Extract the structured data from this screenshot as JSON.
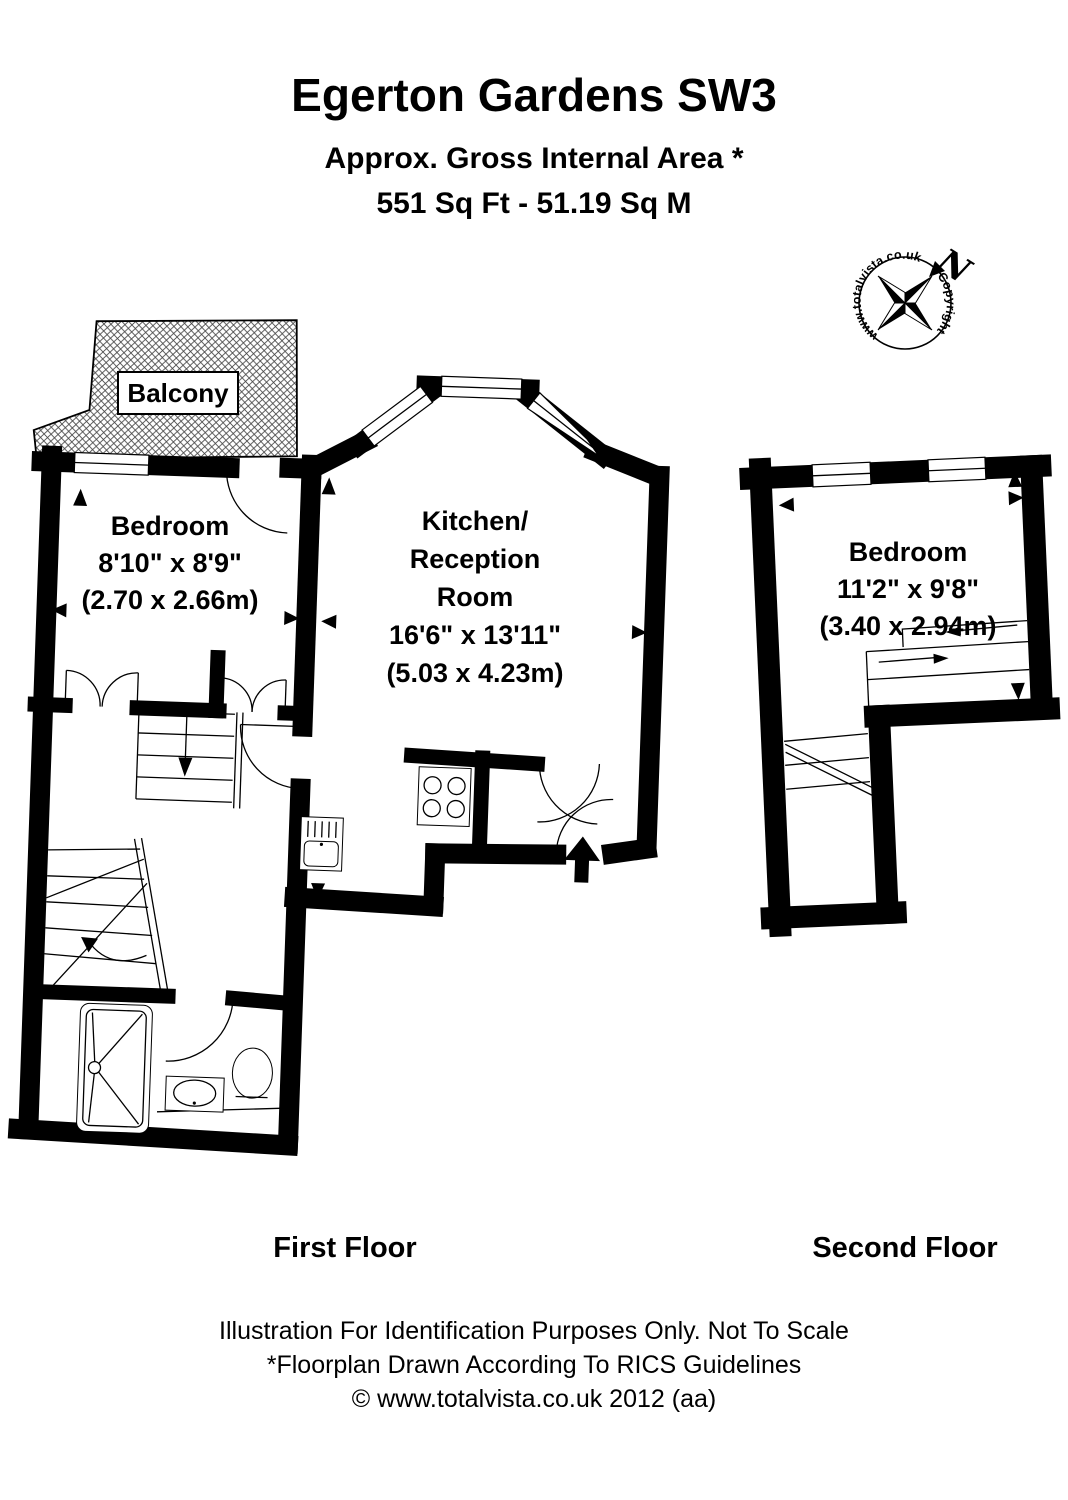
{
  "header": {
    "title": "Egerton Gardens SW3",
    "subtitle_line1": "Approx. Gross Internal Area *",
    "subtitle_line2": "551 Sq Ft  -  51.19 Sq M"
  },
  "compass": {
    "ring_text_left": "www.totalvista.co.uk",
    "ring_text_right": "Copyright",
    "north_label": "N"
  },
  "floorplan": {
    "balcony_label": "Balcony",
    "rooms": {
      "bedroom_first_floor": {
        "name": "Bedroom",
        "imperial": "8'10\" x 8'9\"",
        "metric": "(2.70 x 2.66m)"
      },
      "kitchen_reception": {
        "name_line1": "Kitchen/",
        "name_line2": "Reception",
        "name_line3": "Room",
        "imperial": "16'6\" x 13'11\"",
        "metric": "(5.03 x 4.23m)"
      },
      "bedroom_second_floor": {
        "name": "Bedroom",
        "imperial": "11'2\" x 9'8\"",
        "metric": "(3.40 x 2.94m)"
      }
    },
    "floor_labels": {
      "first": "First Floor",
      "second": "Second Floor"
    }
  },
  "footer": {
    "line1": "Illustration For Identification Purposes Only. Not To Scale",
    "line2": "*Floorplan Drawn According To RICS Guidelines",
    "line3": "© www.totalvista.co.uk  2012 (aa)"
  },
  "colors": {
    "ink": "#000000",
    "paper": "#ffffff"
  }
}
